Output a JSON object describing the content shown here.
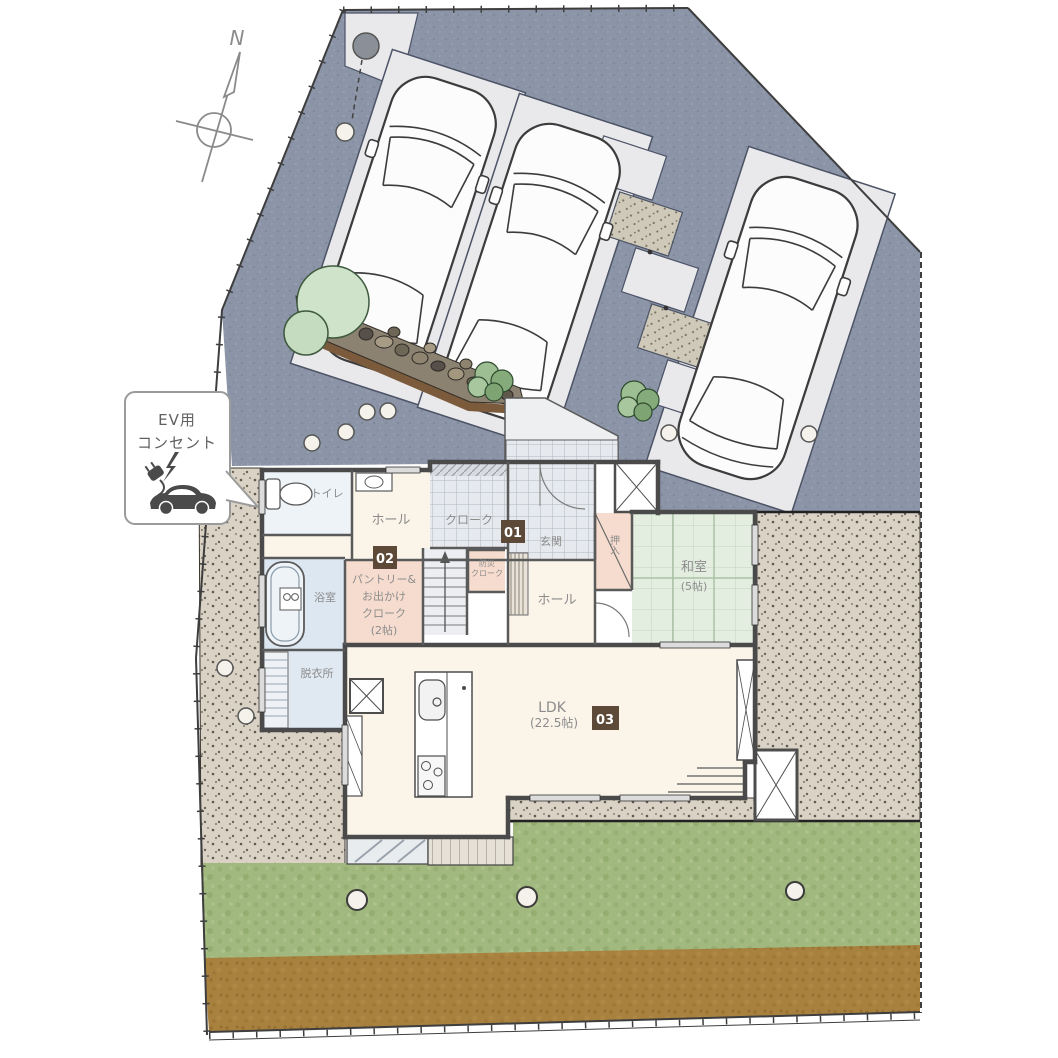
{
  "compass": {
    "north": "N"
  },
  "ev_callout": {
    "line1": "EV用",
    "line2": "コンセント"
  },
  "badges": {
    "b1": "01",
    "b2": "02",
    "b3": "03"
  },
  "rooms": {
    "toilet": "トイレ",
    "hall_upper": "ホール",
    "cloak": "クローク",
    "entrance": "玄関",
    "closet": "押入",
    "washitsu_name": "和室",
    "washitsu_size": "(5帖)",
    "hall_lower": "ホール",
    "emergency_line1": "防災",
    "emergency_line2": "クローク",
    "bath": "浴室",
    "dressing": "脱衣所",
    "pantry_line1": "パントリー&",
    "pantry_line2": "お出かけ",
    "pantry_line3": "クローク",
    "pantry_line4": "(2帖)",
    "ldk_name": "LDK",
    "ldk_size": "(22.5帖)"
  },
  "colors": {
    "driveway": "#8b95a7",
    "parking_pad": "#e9e9ec",
    "gravel": "#d9d2c5",
    "grass": "#a1b87f",
    "soil": "#a8813e",
    "tatami": "#e3eee1",
    "room_pink": "#f6dcce",
    "room_blue": "#dce7f1",
    "room_cream": "#faf4e9",
    "badge_brown": "#5d4937",
    "wall": "#4a4a4a"
  }
}
